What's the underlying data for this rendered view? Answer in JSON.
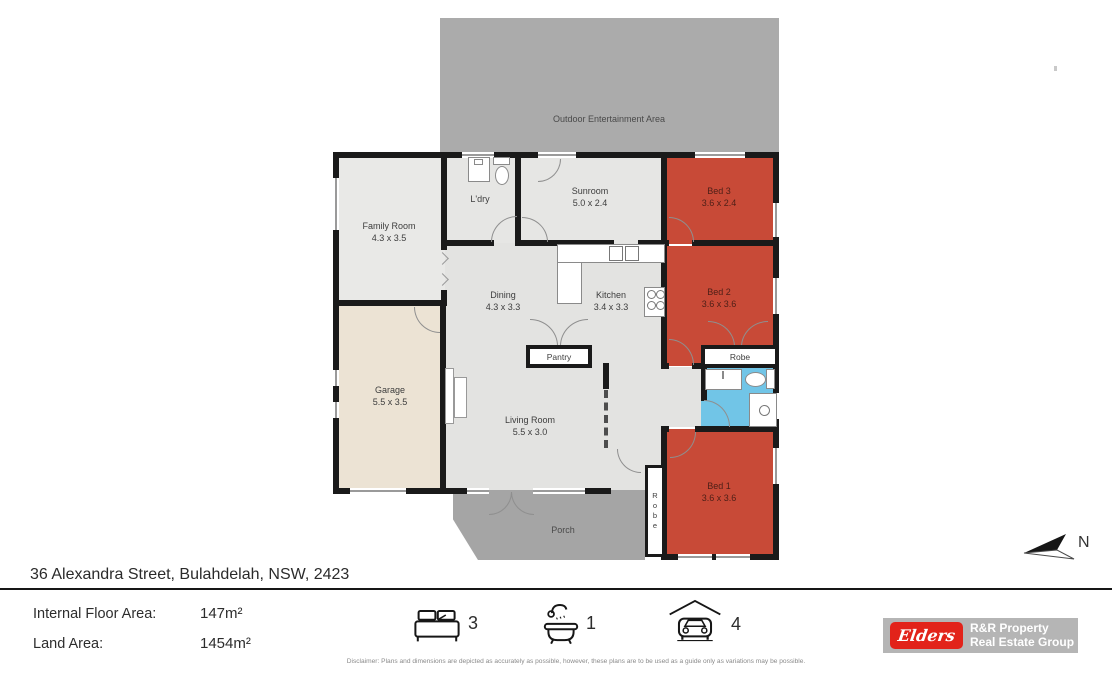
{
  "plan": {
    "rooms": {
      "outdoor": {
        "name": "Outdoor Entertainment Area"
      },
      "family": {
        "name": "Family Room",
        "dims": "4.3 x 3.5"
      },
      "laundry": {
        "name": "L'dry"
      },
      "sunroom": {
        "name": "Sunroom",
        "dims": "5.0 x 2.4"
      },
      "bed3": {
        "name": "Bed 3",
        "dims": "3.6 x 2.4"
      },
      "bed2": {
        "name": "Bed 2",
        "dims": "3.6 x 3.6"
      },
      "dining": {
        "name": "Dining",
        "dims": "4.3 x 3.3"
      },
      "kitchen": {
        "name": "Kitchen",
        "dims": "3.4 x 3.3"
      },
      "pantry": {
        "name": "Pantry"
      },
      "robe_bed2": {
        "name": "Robe"
      },
      "garage": {
        "name": "Garage",
        "dims": "5.5 x 3.5"
      },
      "living": {
        "name": "Living Room",
        "dims": "5.5 x 3.0"
      },
      "porch": {
        "name": "Porch"
      },
      "robe_bed1": {
        "name": "Robe"
      },
      "bed1": {
        "name": "Bed 1",
        "dims": "3.6 x 3.6"
      }
    },
    "compass": {
      "label": "N"
    },
    "colors": {
      "bedroom_red": "#c84a37",
      "bath_blue": "#71c5e7",
      "garage_beige": "#ece3d4",
      "outdoor_grey": "#ababab",
      "porch_grey": "#a5a5a5",
      "floor_grey": "#e3e3e1",
      "wall_black": "#1a1a1a"
    }
  },
  "footer": {
    "address": "36 Alexandra Street, Bulahdelah, NSW, 2423",
    "internal_label": "Internal Floor Area:",
    "internal_value": "147m²",
    "land_label": "Land Area:",
    "land_value": "1454m²",
    "bed_count": "3",
    "bath_count": "1",
    "car_count": "4",
    "disclaimer": "Disclaimer: Plans and dimensions are depicted as accurately as possible, however, these plans are to be used as a guide only as variations may be possible."
  },
  "branding": {
    "logo_text": "Elders",
    "line1": "R&R Property",
    "line2": "Real Estate Group",
    "logo_red": "#e2231a",
    "logo_grey": "#b5b5b5"
  }
}
